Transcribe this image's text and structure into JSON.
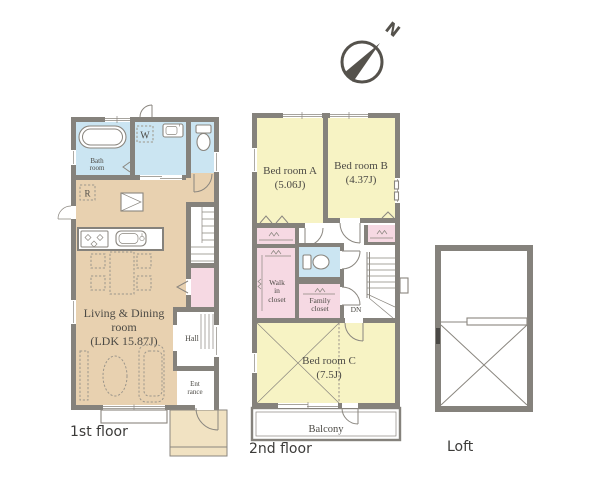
{
  "colors": {
    "wall": "#85827c",
    "line": "#8a867f",
    "furn": "#9c968b",
    "tan": "#e8d1b0",
    "blue": "#cbe5f2",
    "yellow": "#f7f3c4",
    "pink": "#f6d9e3",
    "porch": "#f1e2c2",
    "text": "#4c4a45",
    "caption": "#3c3b39",
    "compass": "#55524c"
  },
  "compass": {
    "north_label": "N"
  },
  "floor1": {
    "caption": "1st floor",
    "bath": {
      "line1": "Bath",
      "line2": "room"
    },
    "washer_label": "W",
    "fridge_label": "R",
    "living": {
      "line1": "Living & Dining",
      "line2": "room",
      "line3": "(LDK 15.87J)"
    },
    "hall_label": "Hall",
    "entrance": {
      "line1": "Ent",
      "line2": "rance"
    }
  },
  "floor2": {
    "caption": "2nd floor",
    "bedroomA": {
      "line1": "Bed room A",
      "line2": "(5.06J)"
    },
    "bedroomB": {
      "line1": "Bed room B",
      "line2": "(4.37J)"
    },
    "bedroomC": {
      "line1": "Bed room C",
      "line2": "(7.5J)"
    },
    "walk_in_closet": {
      "line1": "Walk",
      "line2": "in",
      "line3": "closet"
    },
    "family_closet": {
      "line1": "Family",
      "line2": "closet"
    },
    "down_label": "DN",
    "balcony_label": "Balcony"
  },
  "loft": {
    "caption": "Loft"
  }
}
